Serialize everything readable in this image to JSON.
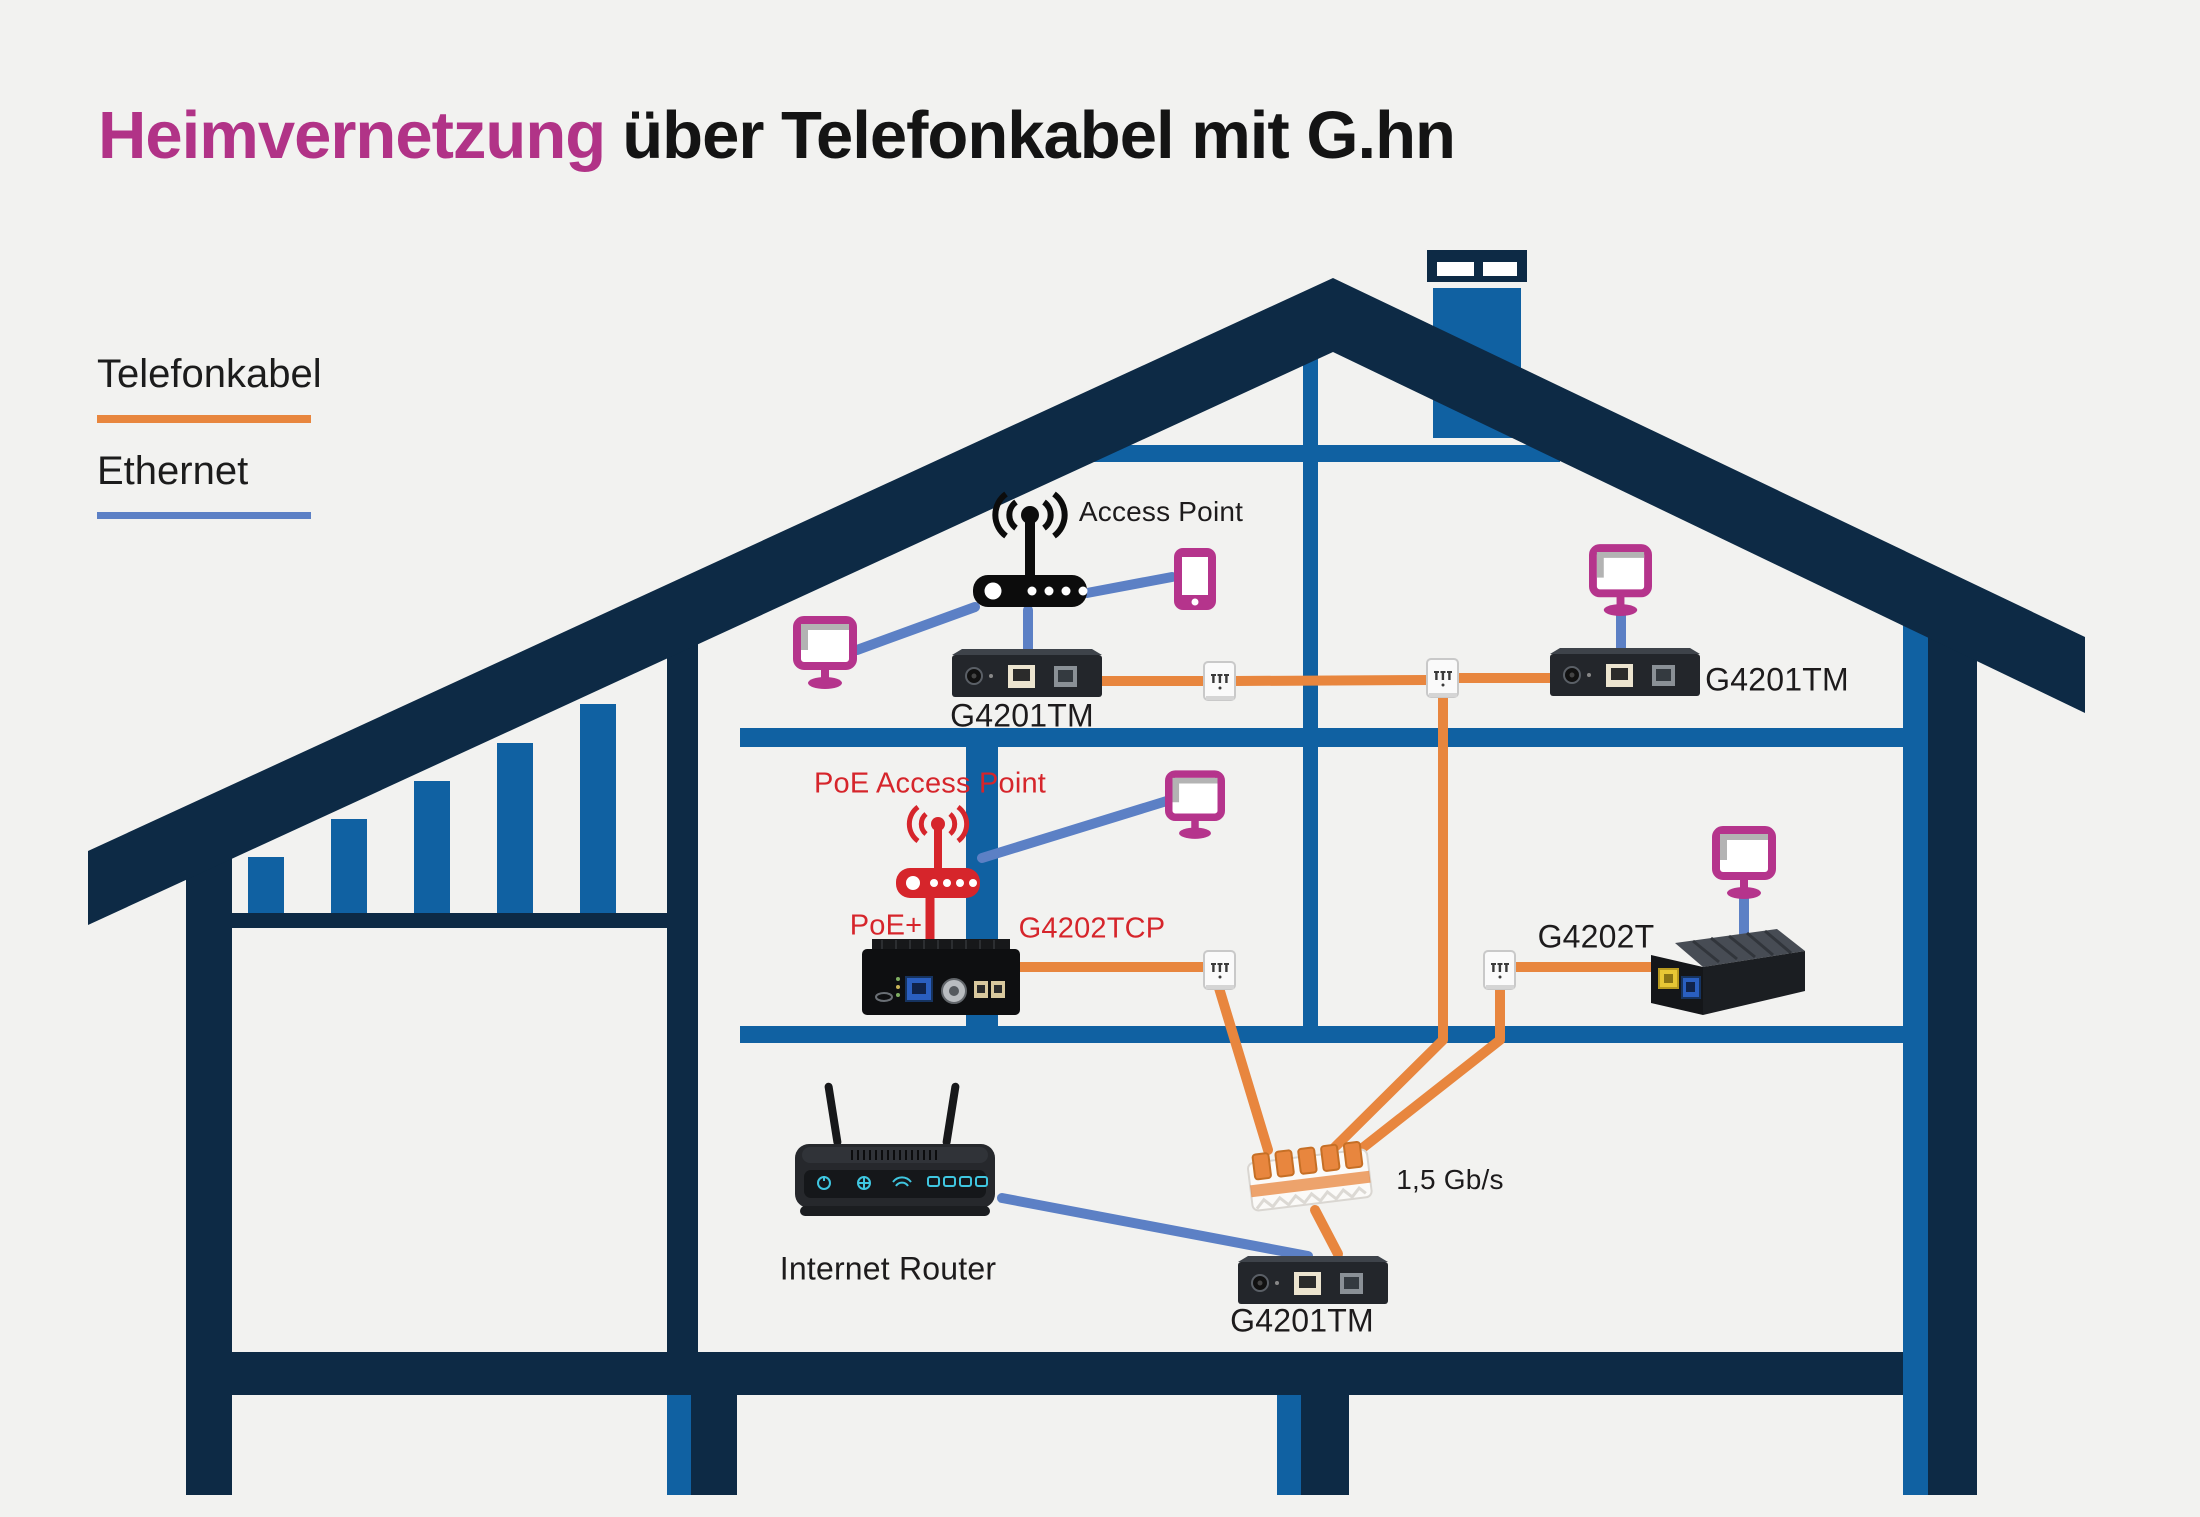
{
  "title": {
    "accent": "Heimvernetzung",
    "rest": "über Telefonkabel mit G.hn"
  },
  "legend": {
    "telefonkabel": "Telefonkabel",
    "ethernet": "Ethernet"
  },
  "attic": {
    "access_point_label": "Access Point",
    "g4201tm_left_label": "G4201TM",
    "g4201tm_right_label": "G4201TM"
  },
  "middle": {
    "poe_access_point_label": "PoE Access Point",
    "poe_plus_label": "PoE+",
    "g4202tcp_label": "G4202TCP",
    "g4202t_label": "G4202T"
  },
  "ground": {
    "internet_router_label": "Internet Router",
    "g4201tm_label": "G4201TM",
    "speed_label": "1,5 Gb/s"
  },
  "icons": {
    "monitor": "monitor-icon",
    "smartphone": "smartphone-icon",
    "access_point": "wifi-router-icon",
    "wall_jack": "telephone-wall-jack-icon",
    "splice_connector": "wire-splice-connector-icon",
    "internet_router": "router-icon"
  },
  "colors": {
    "bg": "#f2f2f0",
    "navy": "#0d2a45",
    "blue": "#1061a2",
    "orange": "#e8863e",
    "ethernet": "#5c80c5",
    "magenta": "#b5348c",
    "red": "#d6252b",
    "text": "#1d1b1c",
    "title_accent": "#b13387"
  }
}
